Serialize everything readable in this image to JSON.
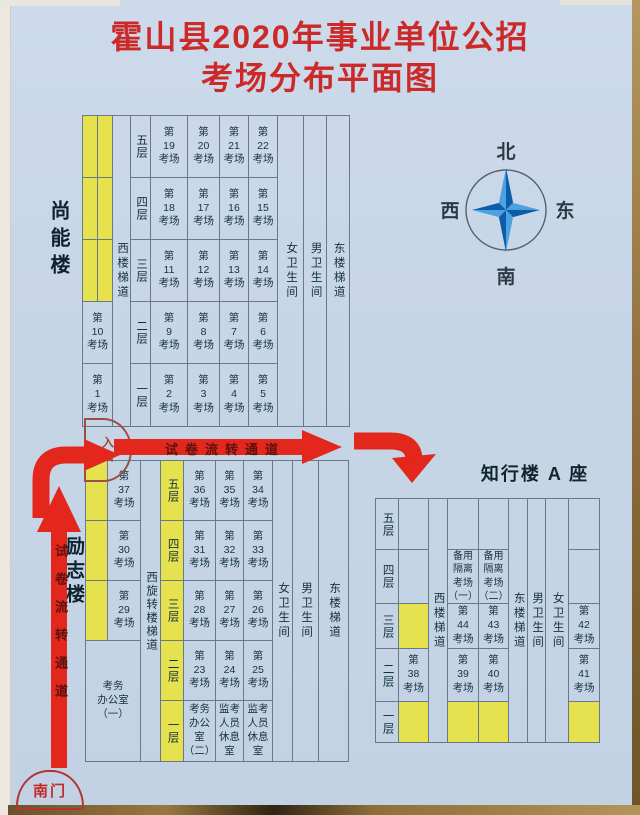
{
  "title": {
    "line1": "霍山县2020年事业单位公招",
    "line2": "考场分布平面图"
  },
  "compass": {
    "north": "北",
    "east": "东",
    "south": "南",
    "west": "西"
  },
  "misc": {
    "channel": "试卷流转通道",
    "entrance": "入口",
    "south_gate": "南门"
  },
  "colors": {
    "background": "#c7d6e7",
    "highlight_yellow": "#e6e14f",
    "arrow_red": "#e3271d",
    "title_red": "#cb2a28",
    "star_light": "#4aa3e0",
    "star_dark": "#0c5ca8"
  },
  "shangneng": {
    "name": "尚能楼",
    "west_stair": "西楼梯道",
    "left_rooms": [
      "第\n10\n考场",
      "第\n1\n考场"
    ],
    "floors": [
      "五层",
      "四层",
      "三层",
      "二层",
      "一层"
    ],
    "rooms": [
      [
        "第\n19\n考场",
        "第\n20\n考场",
        "第\n21\n考场",
        "第\n22\n考场"
      ],
      [
        "第\n18\n考场",
        "第\n17\n考场",
        "第\n16\n考场",
        "第\n15\n考场"
      ],
      [
        "第\n11\n考场",
        "第\n12\n考场",
        "第\n13\n考场",
        "第\n14\n考场"
      ],
      [
        "第\n9\n考场",
        "第\n8\n考场",
        "第\n7\n考场",
        "第\n6\n考场"
      ],
      [
        "第\n2\n考场",
        "第\n3\n考场",
        "第\n4\n考场",
        "第\n5\n考场"
      ]
    ],
    "female_wc": "女卫生间",
    "male_wc": "男卫生间",
    "east_stair": "东楼梯道"
  },
  "lizhi": {
    "name": "励志楼",
    "side_rooms": [
      "第\n37\n考场",
      "第\n30\n考场",
      "第\n29\n考场"
    ],
    "office": "考务\n办公室\n（一）",
    "west_stair": "西旋转楼梯道",
    "floors": [
      "五层",
      "四层",
      "三层",
      "二层",
      "一层"
    ],
    "rooms": [
      [
        "第\n36\n考场",
        "第\n35\n考场",
        "第\n34\n考场"
      ],
      [
        "第\n31\n考场",
        "第\n32\n考场",
        "第\n33\n考场"
      ],
      [
        "第\n28\n考场",
        "第\n27\n考场",
        "第\n26\n考场"
      ],
      [
        "第\n23\n考场",
        "第\n24\n考场",
        "第\n25\n考场"
      ],
      [
        "考务\n办公\n室\n（二）",
        "监考\n人员\n休息\n室",
        "监考\n人员\n休息\n室"
      ]
    ],
    "female_wc": "女卫生间",
    "male_wc": "男卫生间",
    "east_stair": "东楼梯道"
  },
  "zhixing": {
    "name": "知行楼 A 座",
    "floors": [
      "五层",
      "四层",
      "三层",
      "二层",
      "一层"
    ],
    "west_stair": "西楼梯道",
    "east_stair": "东楼梯道",
    "male_wc": "男卫生间",
    "female_wc": "女卫生间",
    "rooms": {
      "backup1": "备用\n隔离\n考场\n（一）",
      "backup2": "备用\n隔离\n考场\n（二）",
      "r38": "第\n38\n考场",
      "r39": "第\n39\n考场",
      "r40": "第\n40\n考场",
      "r41": "第\n41\n考场",
      "r42": "第\n42\n考场",
      "r43": "第\n43\n考场",
      "r44": "第\n44\n考场"
    }
  }
}
